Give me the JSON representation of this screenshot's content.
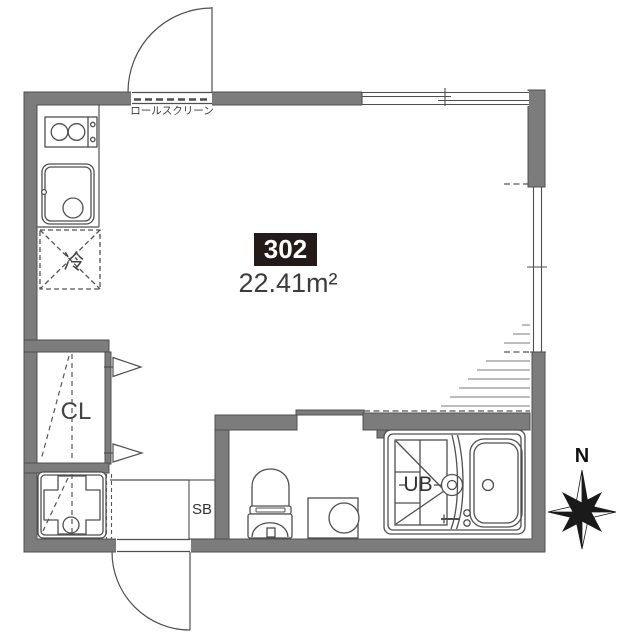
{
  "unit": {
    "number": "302",
    "area": "22.41m²"
  },
  "labels": {
    "roll_screen": "ロールスクリーン",
    "closet": "CL",
    "shoe_box": "SB",
    "unit_bath": "UB",
    "refrigerator": "冷",
    "north": "N"
  },
  "fixtures": {
    "kitchen": [
      "stove-2-burner",
      "kitchen-sink"
    ],
    "sanitary": [
      "toilet",
      "washing-machine-space",
      "unit-bath-vanity",
      "bathtub",
      "washer-pan"
    ],
    "openings": [
      "entry-door-top",
      "entrance-door-bottom",
      "sliding-window-top",
      "sliding-window-right"
    ],
    "other": [
      "sloped-ceiling-hatch",
      "compass-rose"
    ]
  },
  "colors": {
    "wall": "#7c7c7c",
    "line": "#4f4f4f",
    "unit_box_bg": "#241b18",
    "unit_box_text": "#ffffff",
    "label_text": "#3a3a3a"
  }
}
